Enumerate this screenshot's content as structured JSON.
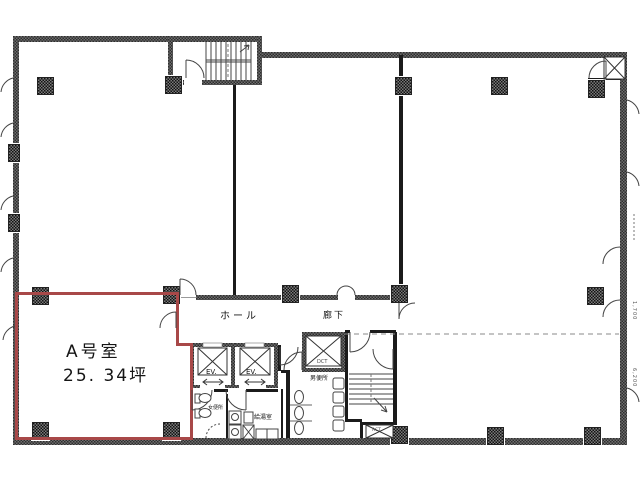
{
  "plan": {
    "unit": {
      "name": "A号室",
      "area": "25. 34坪"
    },
    "rooms": {
      "hall": "ホール",
      "corridor": "廊下",
      "mens_toilet": "男便所",
      "womens_toilet": "女便所",
      "kitchenette": "給湯室"
    },
    "shafts": {
      "elevator_1": "EV.",
      "elevator_2": "EV.",
      "duct": "DCT",
      "vent": "ACT"
    },
    "dimensions": {
      "upper": "1,700",
      "lower": "6,200"
    },
    "colors": {
      "unit_outline": "#a84848",
      "wall_dark": "#2e2e2e"
    }
  }
}
